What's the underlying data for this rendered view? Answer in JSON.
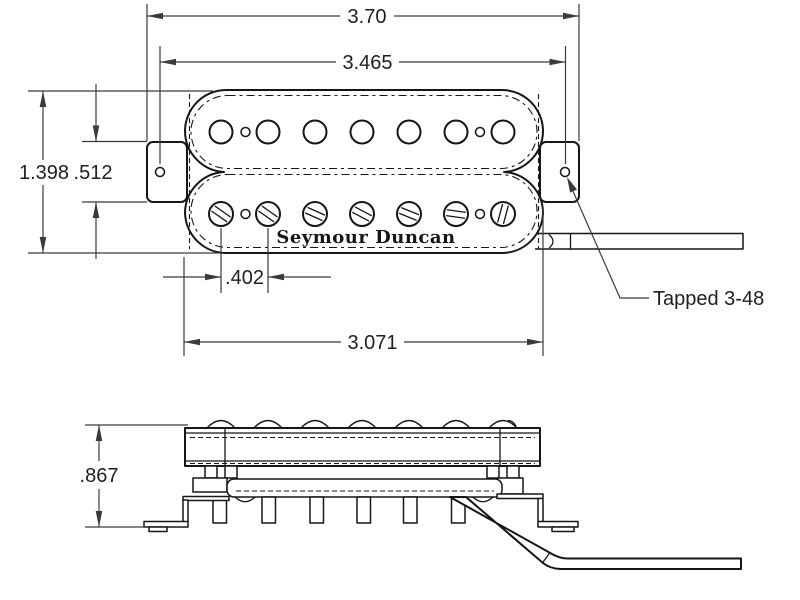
{
  "drawing": {
    "logo": "Seymour Duncan",
    "callout_tapped": "Tapped 3-48",
    "dims": {
      "overall_width": "3.70",
      "mount_hole_spacing": "3.465",
      "overall_height": "1.398",
      "tab_height": ".512",
      "pole_spacing": ".402",
      "body_width": "3.071",
      "side_height": ".867"
    },
    "poles_per_row": 7,
    "colors": {
      "background": "#ffffff",
      "line": "#161616",
      "dim": "#3a3a3a",
      "text": "#1f1f1f"
    }
  }
}
